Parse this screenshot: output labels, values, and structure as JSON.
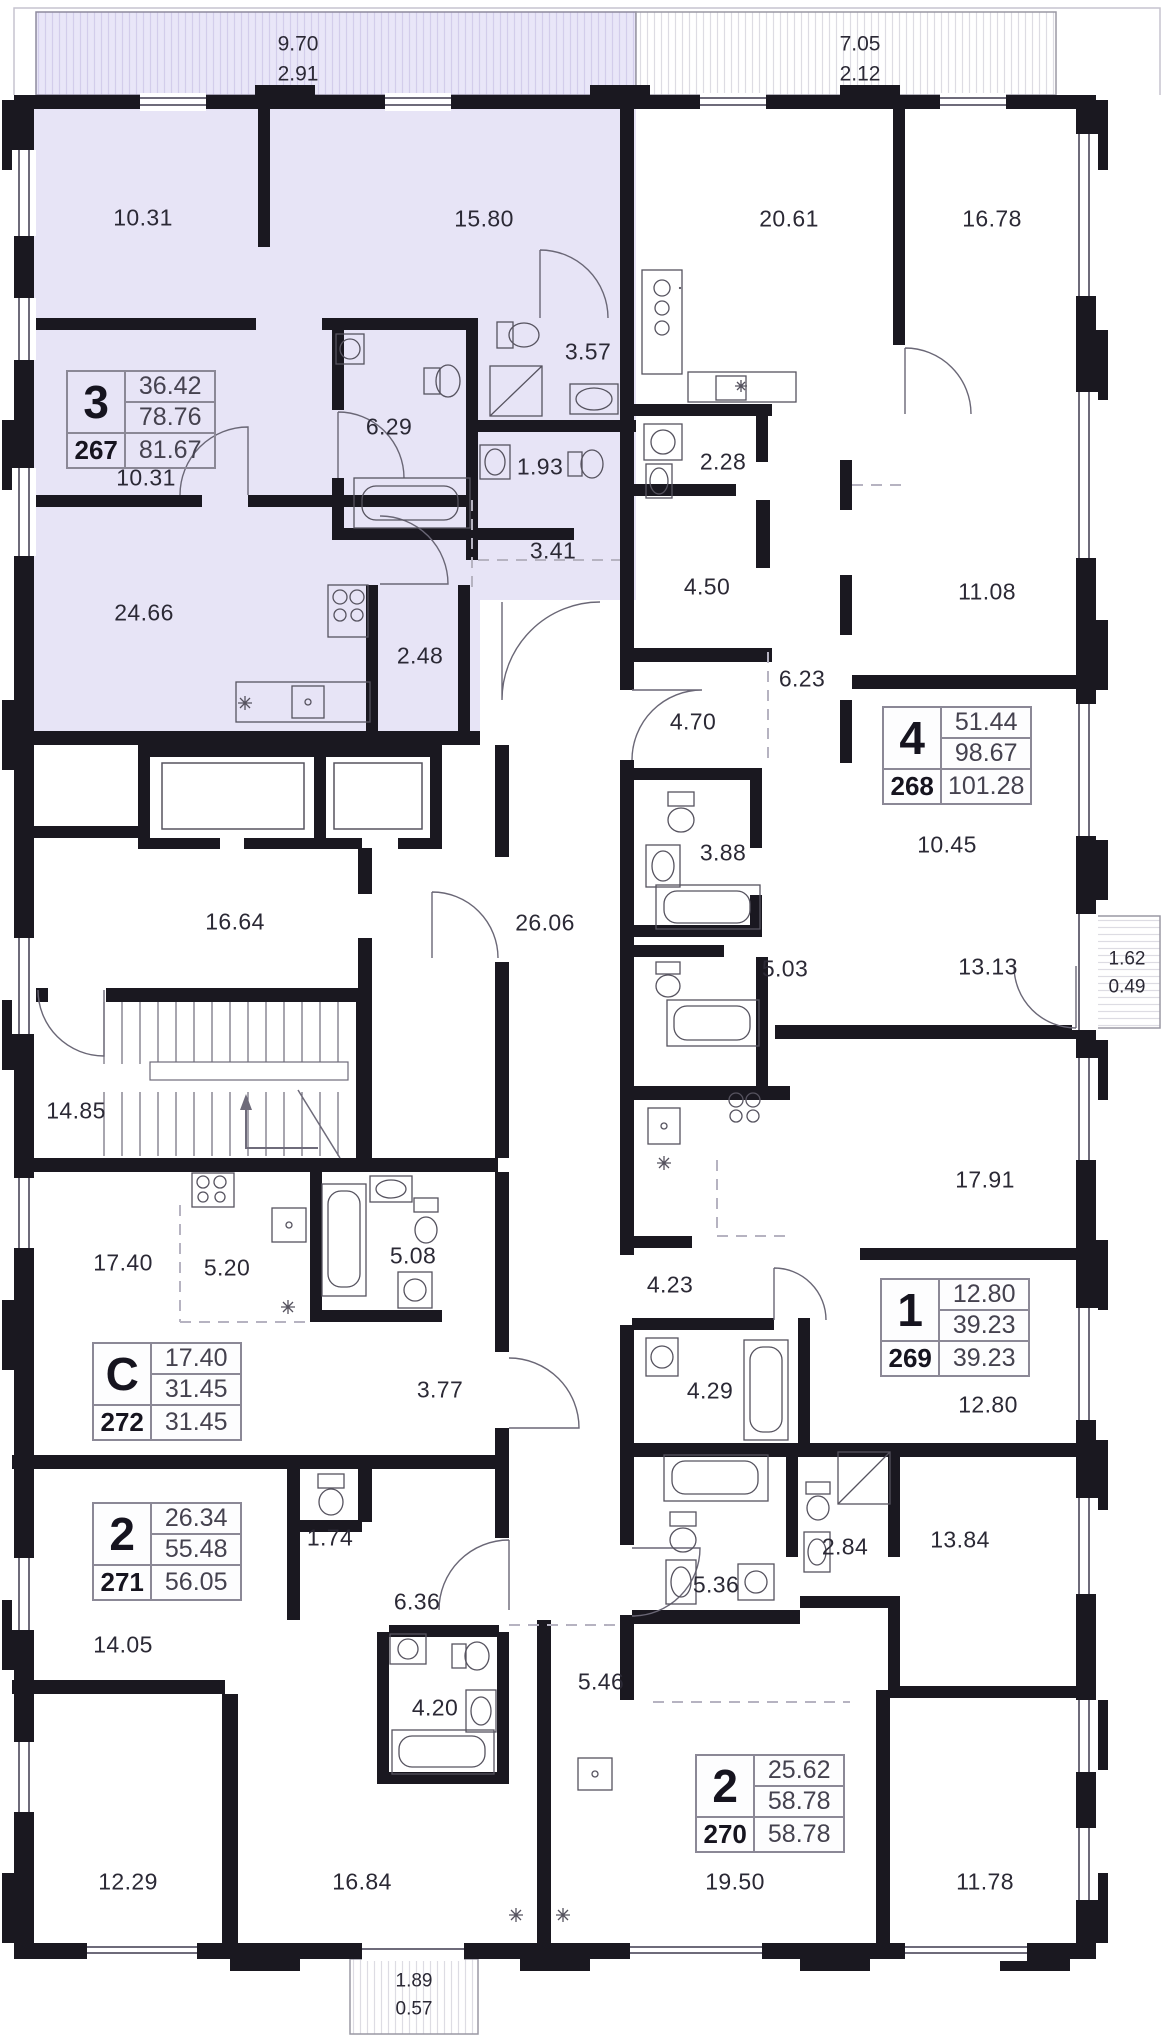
{
  "colors": {
    "highlight_fill": "#e7e4f6",
    "highlight_hatch": "#d3cdeb",
    "wall": "#1a1820",
    "label_text": "#2b2935",
    "card_border": "#8b8896"
  },
  "balconies": [
    {
      "name": "balcony-top-left",
      "line1": "9.70",
      "line2": "2.91",
      "x": 298,
      "y": 60,
      "highlighted": true
    },
    {
      "name": "balcony-top-right",
      "line1": "7.05",
      "line2": "2.12",
      "x": 860,
      "y": 60,
      "highlighted": false
    },
    {
      "name": "balcony-right",
      "line1": "1.62",
      "line2": "0.49",
      "x": 1127,
      "y": 973,
      "highlighted": false
    },
    {
      "name": "balcony-bottom",
      "line1": "1.89",
      "line2": "0.57",
      "x": 414,
      "y": 1995,
      "highlighted": false
    }
  ],
  "rooms": [
    {
      "value": "10.31",
      "x": 143,
      "y": 218
    },
    {
      "value": "15.80",
      "x": 484,
      "y": 219
    },
    {
      "value": "20.61",
      "x": 789,
      "y": 219
    },
    {
      "value": "16.78",
      "x": 992,
      "y": 219
    },
    {
      "value": "3.57",
      "x": 588,
      "y": 352
    },
    {
      "value": "6.29",
      "x": 389,
      "y": 427
    },
    {
      "value": "1.93",
      "x": 540,
      "y": 467
    },
    {
      "value": "2.28",
      "x": 723,
      "y": 462
    },
    {
      "value": "10.31",
      "x": 146,
      "y": 478
    },
    {
      "value": "3.41",
      "x": 553,
      "y": 551
    },
    {
      "value": "24.66",
      "x": 144,
      "y": 613
    },
    {
      "value": "2.48",
      "x": 420,
      "y": 656
    },
    {
      "value": "4.50",
      "x": 707,
      "y": 587
    },
    {
      "value": "6.23",
      "x": 802,
      "y": 679
    },
    {
      "value": "4.70",
      "x": 693,
      "y": 722
    },
    {
      "value": "11.08",
      "x": 987,
      "y": 592
    },
    {
      "value": "10.45",
      "x": 947,
      "y": 845
    },
    {
      "value": "16.64",
      "x": 235,
      "y": 922
    },
    {
      "value": "26.06",
      "x": 545,
      "y": 923
    },
    {
      "value": "3.88",
      "x": 723,
      "y": 853
    },
    {
      "value": "5.03",
      "x": 785,
      "y": 969
    },
    {
      "value": "13.13",
      "x": 988,
      "y": 967
    },
    {
      "value": "14.85",
      "x": 76,
      "y": 1111
    },
    {
      "value": "17.91",
      "x": 985,
      "y": 1180
    },
    {
      "value": "17.40",
      "x": 123,
      "y": 1263
    },
    {
      "value": "5.20",
      "x": 227,
      "y": 1268
    },
    {
      "value": "5.08",
      "x": 413,
      "y": 1256
    },
    {
      "value": "4.23",
      "x": 670,
      "y": 1285
    },
    {
      "value": "4.29",
      "x": 710,
      "y": 1391
    },
    {
      "value": "12.80",
      "x": 988,
      "y": 1405
    },
    {
      "value": "3.77",
      "x": 440,
      "y": 1390
    },
    {
      "value": "1.74",
      "x": 330,
      "y": 1538
    },
    {
      "value": "6.36",
      "x": 417,
      "y": 1602
    },
    {
      "value": "5.36",
      "x": 716,
      "y": 1585
    },
    {
      "value": "2.84",
      "x": 845,
      "y": 1547
    },
    {
      "value": "13.84",
      "x": 960,
      "y": 1540
    },
    {
      "value": "14.05",
      "x": 123,
      "y": 1645
    },
    {
      "value": "5.46",
      "x": 601,
      "y": 1682
    },
    {
      "value": "4.20",
      "x": 435,
      "y": 1708
    },
    {
      "value": "12.29",
      "x": 128,
      "y": 1882
    },
    {
      "value": "16.84",
      "x": 362,
      "y": 1882
    },
    {
      "value": "19.50",
      "x": 735,
      "y": 1882
    },
    {
      "value": "11.78",
      "x": 985,
      "y": 1882
    }
  ],
  "units": [
    {
      "type": "3",
      "number": "267",
      "values": [
        "36.42",
        "78.76",
        "81.67"
      ],
      "x": 66,
      "y": 370,
      "highlighted": true
    },
    {
      "type": "4",
      "number": "268",
      "values": [
        "51.44",
        "98.67",
        "101.28"
      ],
      "x": 882,
      "y": 706,
      "highlighted": false
    },
    {
      "type": "1",
      "number": "269",
      "values": [
        "12.80",
        "39.23",
        "39.23"
      ],
      "x": 880,
      "y": 1278,
      "highlighted": false
    },
    {
      "type": "2",
      "number": "270",
      "values": [
        "25.62",
        "58.78",
        "58.78"
      ],
      "x": 695,
      "y": 1754,
      "highlighted": false
    },
    {
      "type": "2",
      "number": "271",
      "values": [
        "26.34",
        "55.48",
        "56.05"
      ],
      "x": 92,
      "y": 1502,
      "highlighted": false
    },
    {
      "type": "C",
      "number": "272",
      "values": [
        "17.40",
        "31.45",
        "31.45"
      ],
      "x": 92,
      "y": 1342,
      "highlighted": false
    }
  ]
}
